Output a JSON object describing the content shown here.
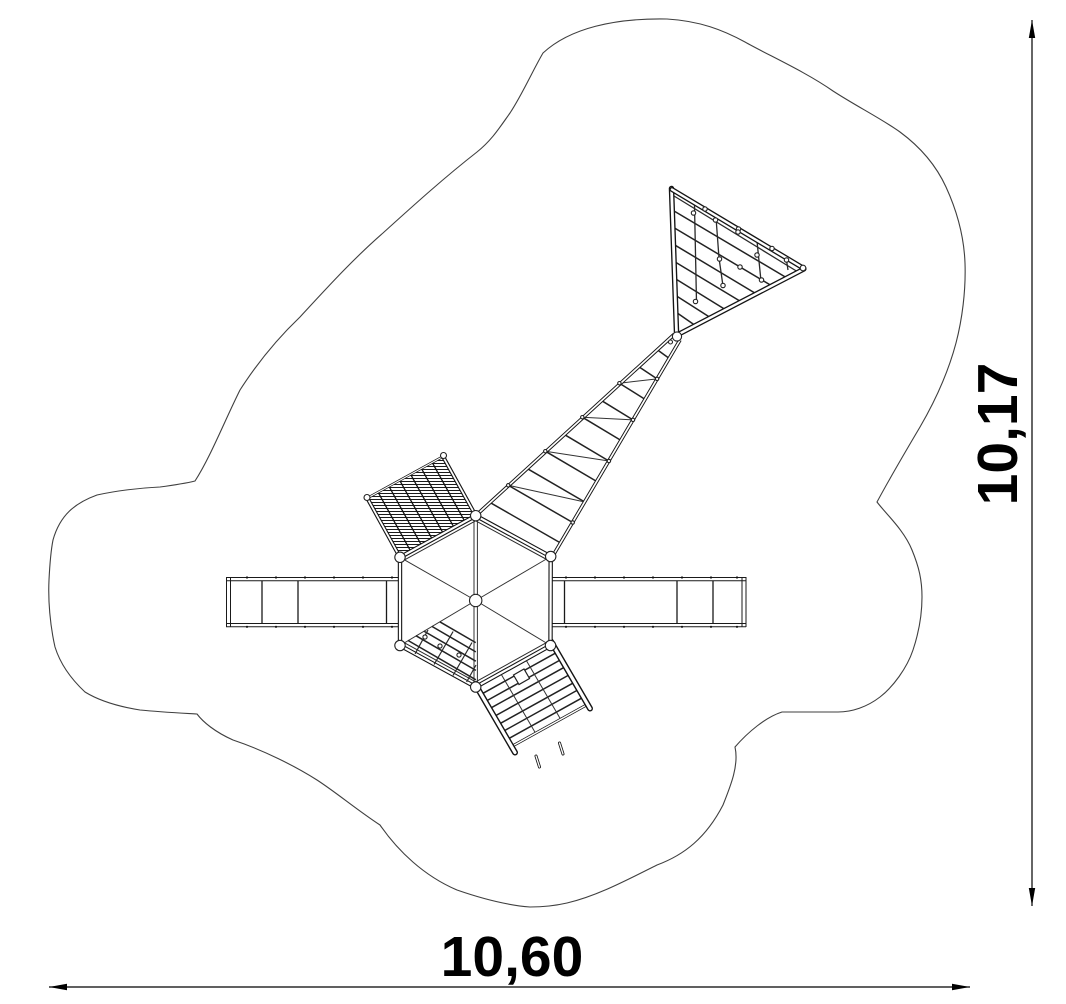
{
  "drawing": {
    "kind": "plan-view technical drawing",
    "parts": [
      "safety-zone-outline",
      "hexagonal-platform",
      "left-balance-bridge",
      "right-balance-bridge",
      "climbing-grid-ramp",
      "rope-net-bridge",
      "triangle-climbing-net",
      "exit-net-ramp",
      "interior-net"
    ]
  },
  "dimensions": {
    "width_label": "10,60",
    "height_label": "10,17"
  },
  "icons": {
    "width_dimension_arrows": "left-right-arrow-line",
    "height_dimension_arrows": "up-down-arrow-line"
  },
  "colors": {
    "background": "#ffffff",
    "structure_line": "#1a1a1a",
    "zone_outline": "#3f3f3f",
    "dimension": "#000000"
  }
}
